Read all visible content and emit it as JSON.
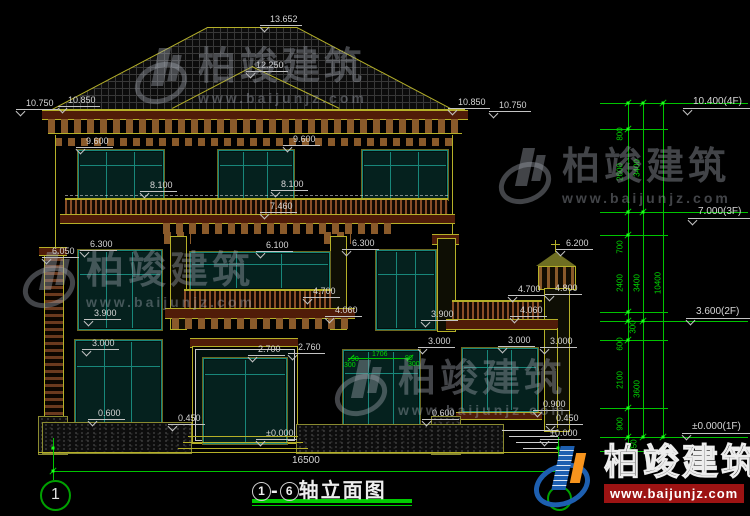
{
  "title_block": {
    "axis_from": "1",
    "axis_to": "6",
    "name": "轴立面图",
    "dash": "-",
    "total_width_dim": "16500"
  },
  "axis_bubbles": {
    "left": "1"
  },
  "watermark": {
    "name": "柏竣建筑",
    "url": "www.baijunjz.com"
  },
  "logo": {
    "name": "柏竣建筑",
    "url": "www.baijunjz.com"
  },
  "colors": {
    "background": "#000000",
    "cad_yellow": "#b5b028",
    "dim_green": "#00d800",
    "text_white": "#d6d6d6",
    "frame_teal": "#18877a",
    "band_maroon": "#501c08",
    "rail_brown": "#8a4e28",
    "logo_blue": "#1d5fb0",
    "logo_orange": "#f7941d",
    "logo_red": "#9c1313",
    "title_underline_green": "#00cc00"
  },
  "level_markers": [
    {
      "t": "10.400(4F)",
      "x": 683,
      "y": 97
    },
    {
      "t": "7.000(3F)",
      "x": 688,
      "y": 207
    },
    {
      "t": "3.600(2F)",
      "x": 686,
      "y": 307
    },
    {
      "t": "±0.000(1F)",
      "x": 682,
      "y": 422
    }
  ],
  "elevation_labels": [
    {
      "t": "13.652",
      "x": 260,
      "y": 14
    },
    {
      "t": "12.250",
      "x": 246,
      "y": 60
    },
    {
      "t": "10.750",
      "x": 16,
      "y": 98
    },
    {
      "t": "10.850",
      "x": 58,
      "y": 95
    },
    {
      "t": "10.850",
      "x": 448,
      "y": 97
    },
    {
      "t": "10.750",
      "x": 489,
      "y": 100
    },
    {
      "t": "9.600",
      "x": 76,
      "y": 136
    },
    {
      "t": "9.600",
      "x": 283,
      "y": 134
    },
    {
      "t": "8.100",
      "x": 140,
      "y": 180
    },
    {
      "t": "8.100",
      "x": 271,
      "y": 179
    },
    {
      "t": "7.460",
      "x": 260,
      "y": 201
    },
    {
      "t": "6.050",
      "x": 42,
      "y": 246
    },
    {
      "t": "6.300",
      "x": 80,
      "y": 239
    },
    {
      "t": "6.100",
      "x": 256,
      "y": 240
    },
    {
      "t": "6.300",
      "x": 342,
      "y": 238
    },
    {
      "t": "6.200",
      "x": 556,
      "y": 238
    },
    {
      "t": "4.700",
      "x": 303,
      "y": 286
    },
    {
      "t": "4.700",
      "x": 508,
      "y": 284
    },
    {
      "t": "4.800",
      "x": 545,
      "y": 283
    },
    {
      "t": "4.060",
      "x": 325,
      "y": 305
    },
    {
      "t": "4.060",
      "x": 510,
      "y": 305
    },
    {
      "t": "3.900",
      "x": 84,
      "y": 308
    },
    {
      "t": "3.900",
      "x": 421,
      "y": 309
    },
    {
      "t": "3.000",
      "x": 82,
      "y": 338
    },
    {
      "t": "3.000",
      "x": 418,
      "y": 336
    },
    {
      "t": "3.000",
      "x": 498,
      "y": 335
    },
    {
      "t": "3.000",
      "x": 540,
      "y": 336
    },
    {
      "t": "2.700",
      "x": 248,
      "y": 344
    },
    {
      "t": "2.760",
      "x": 288,
      "y": 342
    },
    {
      "t": "0.600",
      "x": 88,
      "y": 408
    },
    {
      "t": "0.450",
      "x": 168,
      "y": 413
    },
    {
      "t": "±0.000",
      "x": 256,
      "y": 428
    },
    {
      "t": "0.600",
      "x": 422,
      "y": 408
    },
    {
      "t": "0.900",
      "x": 533,
      "y": 399
    },
    {
      "t": "0.450",
      "x": 546,
      "y": 413
    },
    {
      "t": "±0.000",
      "x": 540,
      "y": 428
    }
  ],
  "chain_dims_vertical": [
    {
      "t": "800",
      "x": 620,
      "y": 134
    },
    {
      "t": "2600",
      "x": 620,
      "y": 172
    },
    {
      "t": "3400",
      "x": 637,
      "y": 168
    },
    {
      "t": "700",
      "x": 620,
      "y": 247
    },
    {
      "t": "2400",
      "x": 620,
      "y": 283
    },
    {
      "t": "3400",
      "x": 637,
      "y": 283
    },
    {
      "t": "10400",
      "x": 658,
      "y": 283
    },
    {
      "t": "300",
      "x": 633,
      "y": 327
    },
    {
      "t": "600",
      "x": 620,
      "y": 344
    },
    {
      "t": "2100",
      "x": 620,
      "y": 380
    },
    {
      "t": "3600",
      "x": 637,
      "y": 389
    },
    {
      "t": "900",
      "x": 620,
      "y": 424
    },
    {
      "t": "450",
      "x": 634,
      "y": 446
    }
  ],
  "small_dims": [
    {
      "t": "1706",
      "x": 372,
      "y": 351
    },
    {
      "t": "90",
      "x": 351,
      "y": 356
    },
    {
      "t": "90",
      "x": 405,
      "y": 355
    },
    {
      "t": "300",
      "x": 344,
      "y": 362
    },
    {
      "t": "300",
      "x": 408,
      "y": 361
    }
  ]
}
